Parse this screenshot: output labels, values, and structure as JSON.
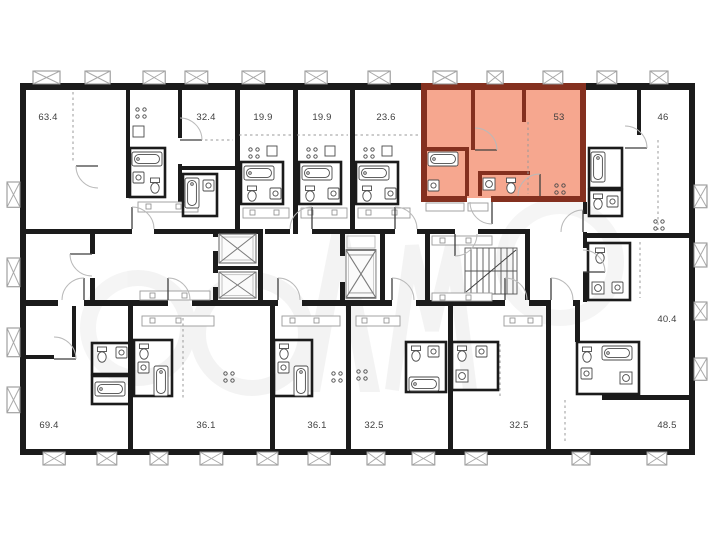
{
  "plan": {
    "kind": "residential floor plan",
    "highlighted_area": "53",
    "colors": {
      "wall": "#1b1b1b",
      "background": "#ffffff",
      "highlight_fill": "#f6a78f",
      "highlight_wall": "#84301f"
    },
    "elevator_count": 3,
    "stairwell_count": 1
  },
  "apartments": [
    {
      "area": "63.4",
      "highlighted": false
    },
    {
      "area": "32.4",
      "highlighted": false
    },
    {
      "area": "19.9",
      "highlighted": false
    },
    {
      "area": "19.9",
      "highlighted": false
    },
    {
      "area": "23.6",
      "highlighted": false
    },
    {
      "area": "53",
      "highlighted": true
    },
    {
      "area": "46",
      "highlighted": false
    },
    {
      "area": "40.4",
      "highlighted": false
    },
    {
      "area": "69.4",
      "highlighted": false
    },
    {
      "area": "36.1",
      "highlighted": false
    },
    {
      "area": "36.1",
      "highlighted": false
    },
    {
      "area": "32.5",
      "highlighted": false
    },
    {
      "area": "32.5",
      "highlighted": false
    },
    {
      "area": "48.5",
      "highlighted": false
    }
  ]
}
